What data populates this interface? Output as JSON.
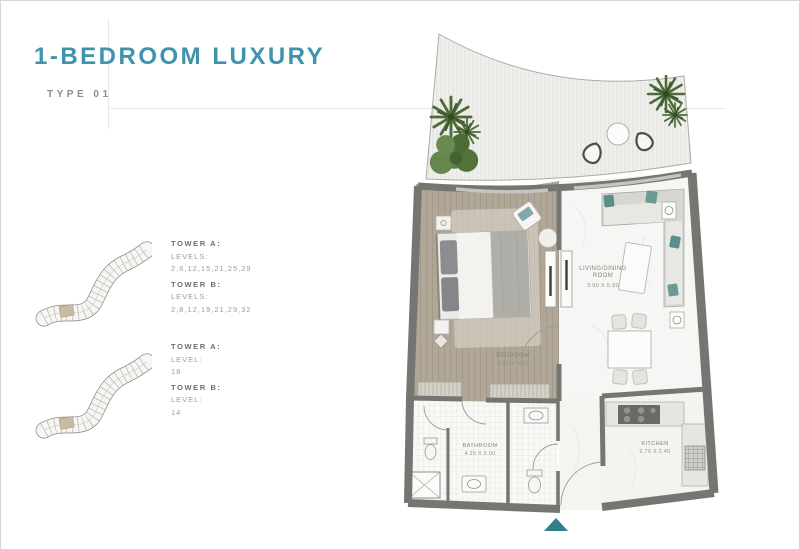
{
  "page": {
    "title": "1-BEDROOM LUXURY",
    "subtitle": "TYPE 01"
  },
  "colors": {
    "accent_teal": "#3E93AD",
    "entrance_arrow": "#2E7E8D",
    "keyplan_highlight": "#C8BDA2"
  },
  "keyplans": [
    {
      "tower_a_label": "TOWER A:",
      "tower_a_levels_label": "LEVELS:",
      "tower_a_levels": "2,6,12,15,21,25,29",
      "tower_b_label": "TOWER B:",
      "tower_b_levels_label": "LEVELS:",
      "tower_b_levels": "2,8,12,19,21,29,32"
    },
    {
      "tower_a_label": "TOWER A:",
      "tower_a_levels_label": "LEVEL:",
      "tower_a_levels": "18",
      "tower_b_label": "TOWER B:",
      "tower_b_levels_label": "LEVEL:",
      "tower_b_levels": "14"
    }
  ],
  "floorplan": {
    "rooms": {
      "bedroom": {
        "name": "BEDROOM",
        "dims": "3.80 X 5.00"
      },
      "living": {
        "name_line1": "LIVING/DINING",
        "name_line2": "ROOM",
        "dims": "3.90 X 5.90"
      },
      "bathroom": {
        "name": "BATHROOM",
        "dims": "4.20 X 2.00"
      },
      "kitchen": {
        "name": "KITCHEN",
        "dims": "2.70 X 2.40"
      }
    }
  }
}
